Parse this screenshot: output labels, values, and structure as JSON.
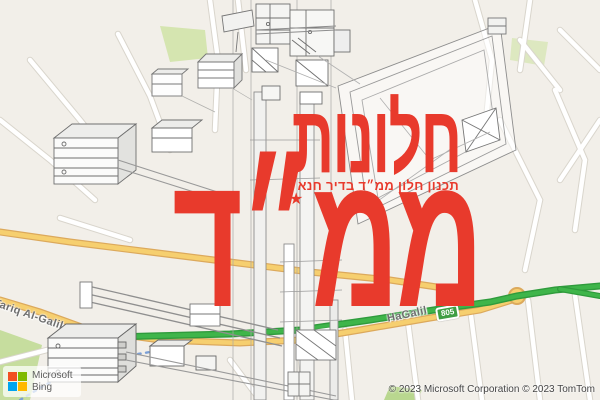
{
  "overlay": {
    "title_line1": "חלונות",
    "subtitle": "תכנון חלון ממ״ד בדיר חנא",
    "title_line2": "ממ״ד",
    "star_glyph": "★",
    "accent_color": "#e83a2c"
  },
  "map": {
    "road_labels": [
      {
        "text": "Tariq Al-Galil"
      },
      {
        "text": "HaGalil"
      }
    ],
    "shields": [
      "805",
      "805"
    ],
    "colors": {
      "land": "#f2efe9",
      "road_yellow": "#f6cf6f",
      "road_green": "#3fb54a",
      "green_area": "#d5e5b0"
    }
  },
  "branding": {
    "company": "Microsoft",
    "product": "Bing"
  },
  "attribution": "© 2023 Microsoft Corporation © 2023 TomTom"
}
